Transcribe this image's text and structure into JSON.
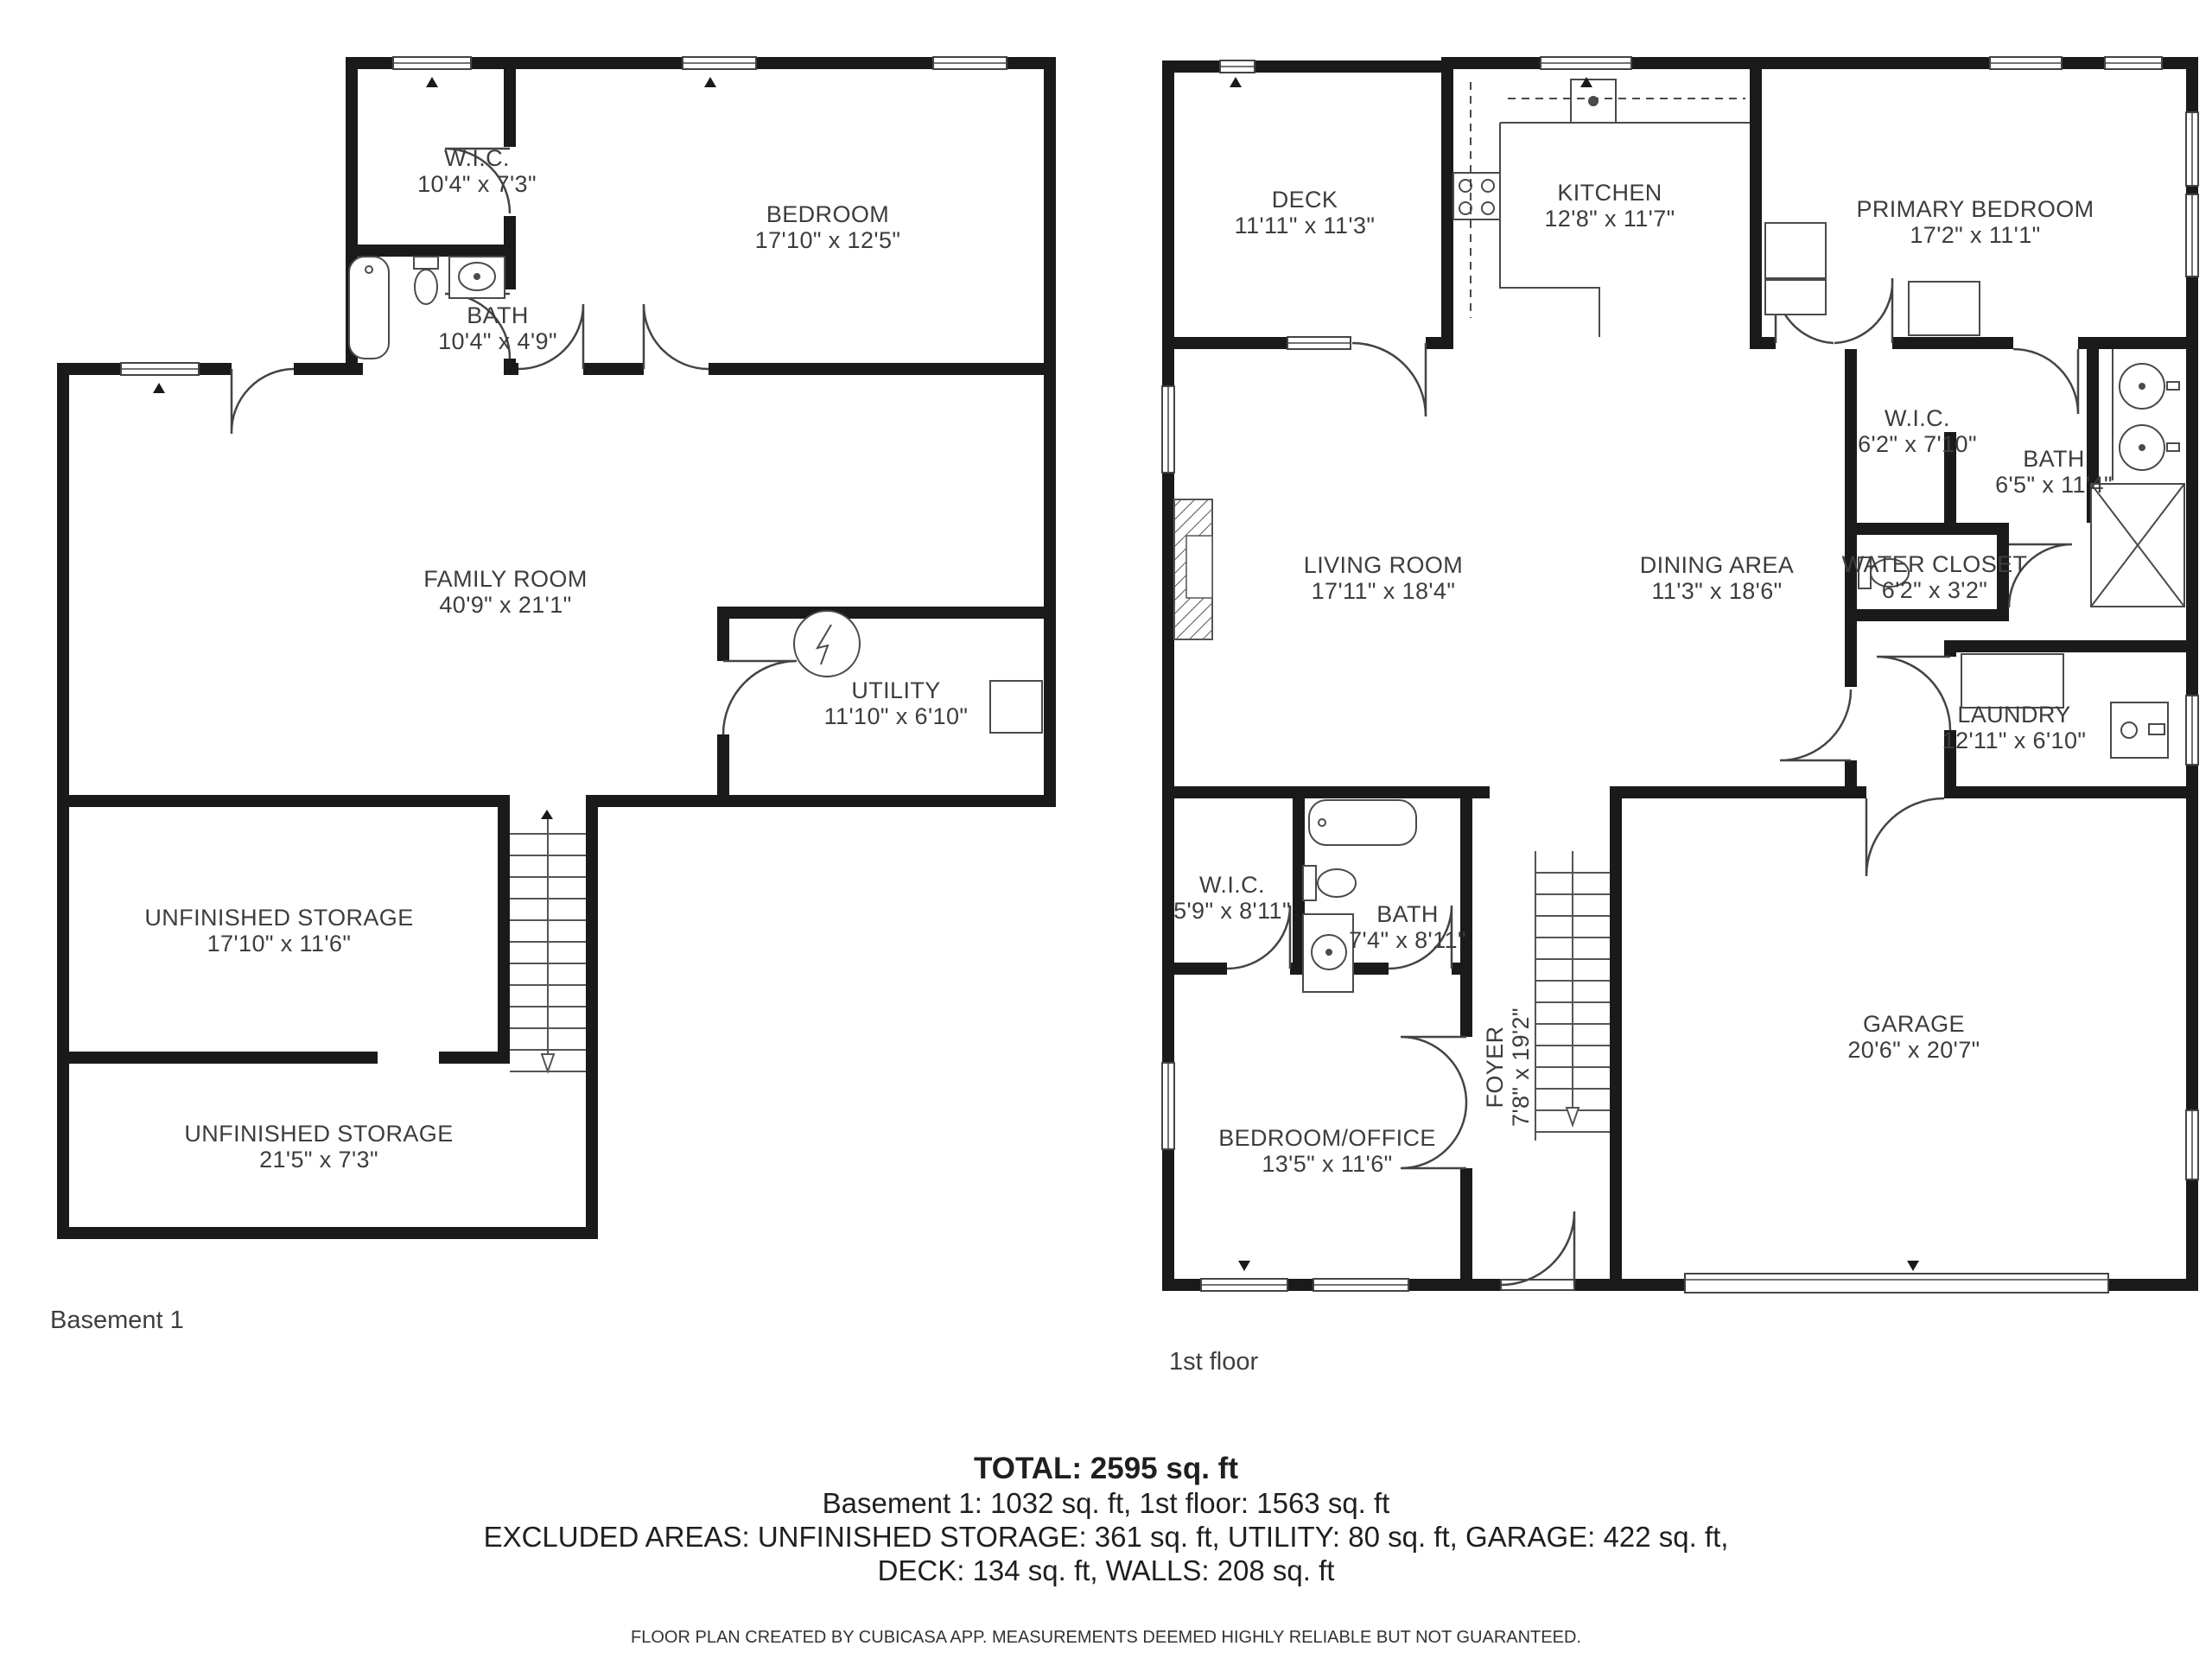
{
  "page": {
    "background": "#ffffff",
    "wall_color": "#1a1a1a",
    "line_color": "#4a4a4a",
    "text_color": "#3d3d3d"
  },
  "floors": [
    {
      "title": "Basement 1",
      "rooms": [
        {
          "name": "W.I.C.",
          "dims": "10'4\" x 7'3\""
        },
        {
          "name": "BATH",
          "dims": "10'4\" x 4'9\""
        },
        {
          "name": "BEDROOM",
          "dims": "17'10\" x 12'5\""
        },
        {
          "name": "FAMILY ROOM",
          "dims": "40'9\" x 21'1\""
        },
        {
          "name": "UTILITY",
          "dims": "11'10\" x 6'10\""
        },
        {
          "name": "UNFINISHED STORAGE",
          "dims": "17'10\" x 11'6\""
        },
        {
          "name": "UNFINISHED STORAGE",
          "dims": "21'5\" x 7'3\""
        }
      ]
    },
    {
      "title": "1st floor",
      "rooms": [
        {
          "name": "DECK",
          "dims": "11'11\" x 11'3\""
        },
        {
          "name": "KITCHEN",
          "dims": "12'8\" x 11'7\""
        },
        {
          "name": "PRIMARY BEDROOM",
          "dims": "17'2\" x 11'1\""
        },
        {
          "name": "LIVING ROOM",
          "dims": "17'11\" x 18'4\""
        },
        {
          "name": "DINING AREA",
          "dims": "11'3\" x 18'6\""
        },
        {
          "name": "W.I.C.",
          "dims": "6'2\" x 7'10\""
        },
        {
          "name": "BATH",
          "dims": "6'5\" x 11'4\""
        },
        {
          "name": "WATER CLOSET",
          "dims": "6'2\" x 3'2\""
        },
        {
          "name": "LAUNDRY",
          "dims": "12'11\" x 6'10\""
        },
        {
          "name": "W.I.C.",
          "dims": "5'9\" x 8'11\""
        },
        {
          "name": "BATH",
          "dims": "7'4\" x 8'11\""
        },
        {
          "name": "FOYER",
          "dims": "7'8\" x 19'2\""
        },
        {
          "name": "BEDROOM/OFFICE",
          "dims": "13'5\" x 11'6\""
        },
        {
          "name": "GARAGE",
          "dims": "20'6\" x 20'7\""
        }
      ]
    }
  ],
  "summary": {
    "total": "TOTAL: 2595 sq. ft",
    "floors_line": "Basement 1: 1032 sq. ft, 1st floor: 1563 sq. ft",
    "excluded_line1": "EXCLUDED AREAS: UNFINISHED STORAGE: 361 sq. ft, UTILITY: 80 sq. ft, GARAGE: 422 sq. ft,",
    "excluded_line2": "DECK: 134 sq. ft, WALLS: 208 sq. ft",
    "footer": "FLOOR PLAN CREATED BY CUBICASA APP. MEASUREMENTS DEEMED HIGHLY RELIABLE BUT NOT GUARANTEED."
  }
}
